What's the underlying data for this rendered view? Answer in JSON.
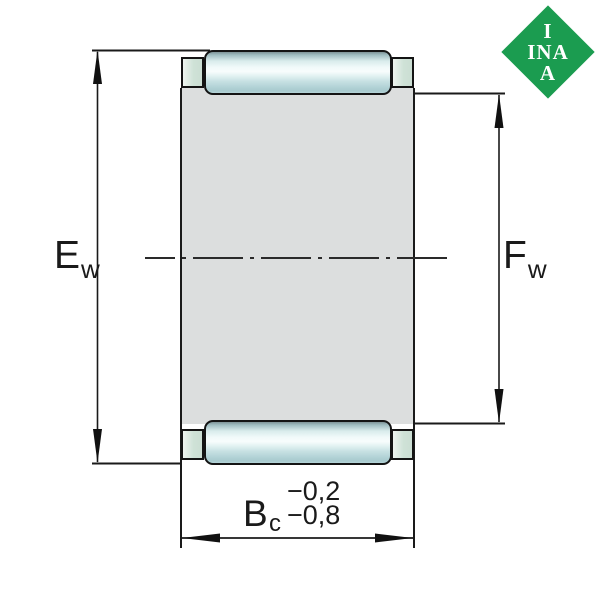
{
  "logo": {
    "line1": "I",
    "line2": "INA",
    "line3": "A",
    "green": "#1B9C50",
    "text_color": "#FFFFFF"
  },
  "dimensions": {
    "outer_diameter": {
      "label": "E",
      "subscript": "w"
    },
    "inner_diameter": {
      "label": "F",
      "subscript": "w"
    },
    "cage_width": {
      "label": "B",
      "subscript": "c",
      "tolerance_upper": "−0,2",
      "tolerance_lower": "−0,8"
    }
  },
  "colors": {
    "background": "#FFFFFF",
    "cage_body_gray": "#DCDEDE",
    "roller_highlight": "#F2FAFA",
    "roller_shade": "#A8CACE",
    "roller_dark_edge": "#7E9397",
    "cage_tab_green": "#CFE2D7",
    "line_black": "#1A1A1A"
  }
}
